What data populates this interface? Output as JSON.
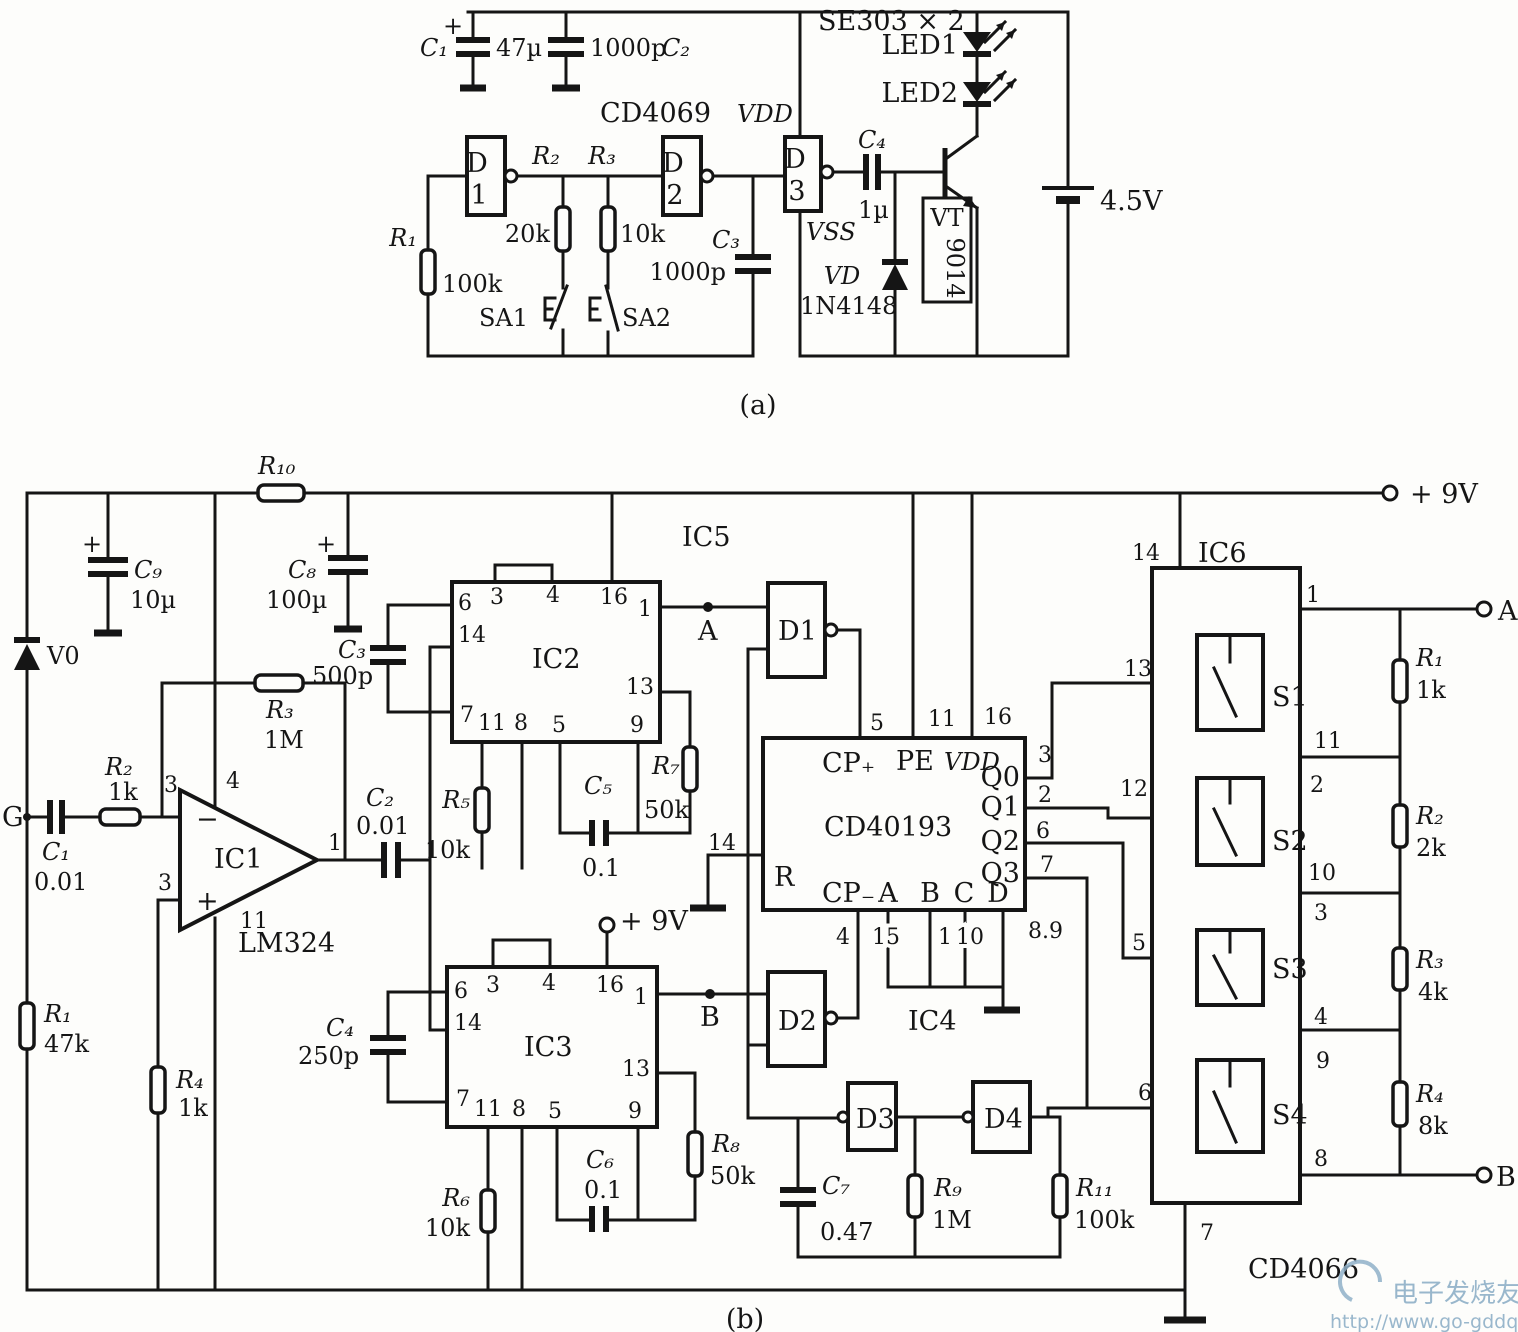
{
  "a": {
    "c1": "C₁",
    "plus": "+",
    "c1v": "47µ",
    "c2v": "1000p",
    "c2": "C₂",
    "ic": "CD4069",
    "vdd": "VDD",
    "vss": "VSS",
    "d": "D",
    "n1": "1",
    "n2": "2",
    "n3": "3",
    "r2": "R₂",
    "r2v": "20k",
    "r3": "R₃",
    "r3v": "10k",
    "r1": "R₁",
    "r1v": "100k",
    "sa1": "SA1",
    "sa2": "SA2",
    "c3": "C₃",
    "c3v": "1000p",
    "c4": "C₄",
    "c4v": "1µ",
    "vd": "VD",
    "vdv": "1N4148",
    "vt": "VT",
    "vtv": "9014",
    "se": "SE303 × 2",
    "led1": "LED1",
    "led2": "LED2",
    "bat": "4.5V",
    "cap": "(a)"
  },
  "b": {
    "pwr9": "+ 9V",
    "r10": "R₁₀",
    "c9": "C₉",
    "c9v": "10µ",
    "c8": "C₈",
    "c8v": "100µ",
    "c3": "C₃",
    "c3v": "500p",
    "v0": "V0",
    "r3": "R₃",
    "r3v": "1M",
    "r2": "R₂",
    "r2v": "1k",
    "c1": "C₁",
    "c1v": "0.01",
    "g": "G",
    "r1": "R₁",
    "r1v": "47k",
    "r4": "R₄",
    "r4v": "1k",
    "minus": "−",
    "plus": "+",
    "ic1": "IC1",
    "lm": "LM324",
    "icpins": [
      "6",
      "3",
      "4",
      "16",
      "1",
      "14",
      "13",
      "7",
      "11",
      "8",
      "5",
      "9"
    ],
    "c2": "C₂",
    "c2v": "0.01",
    "ic5": "IC5",
    "ic2": "IC2",
    "r5": "R₅",
    "r5v": "10k",
    "c5": "C₅",
    "c5v": "0.1",
    "r7": "R₇",
    "r7v": "50k",
    "a": "A",
    "d1": "D1",
    "d2": "D2",
    "d3": "D3",
    "d4": "D4",
    "c4": "C₄",
    "c4v": "250p",
    "ic3": "IC3",
    "r6": "R₆",
    "r6v": "10k",
    "c6": "C₆",
    "c6v": "0.1",
    "r8": "R₈",
    "r8v": "50k",
    "bnode": "B",
    "pwr9b": "+ 9V",
    "cd": "CD40193",
    "cpu": "CP₊",
    "pe": "PE",
    "vdd": "VDD",
    "r": "R",
    "cpd": "CP₋",
    "pa": "A",
    "pb": "B",
    "pc": "C",
    "pd": "D",
    "q0": "Q0",
    "q1": "Q1",
    "q2": "Q2",
    "q3": "Q3",
    "t5": "5",
    "t11": "11",
    "t16": "16",
    "t14": "14",
    "t4": "4",
    "t15": "15",
    "t1": "1",
    "t10": "10",
    "t89": "8.9",
    "ic4": "IC4",
    "q0p": "3",
    "q1p": "2",
    "q2p": "6",
    "q3p": "7",
    "s1c": "13",
    "s2c": "12",
    "s3c": "5",
    "s4c": "6",
    "c7": "C₇",
    "c7v": "0.47",
    "r9": "R₉",
    "r9v": "1M",
    "r11": "R₁₁",
    "r11v": "100k",
    "ic6": "IC6",
    "ic6p14": "14",
    "ic6p7": "7",
    "cd4066": "CD4066",
    "s1": "S1",
    "s2": "S2",
    "s3": "S3",
    "s4": "S4",
    "e1": "1",
    "e11": "11",
    "e2": "2",
    "e10": "10",
    "e3": "3",
    "e4": "4",
    "e9": "9",
    "e8": "8",
    "lr1": "R₁",
    "lr1v": "1k",
    "lr2": "R₂",
    "lr2v": "2k",
    "lr3": "R₃",
    "lr3v": "4k",
    "lr4": "R₄",
    "lr4v": "8k",
    "ta": "A",
    "tb": "B",
    "cap": "(b)"
  },
  "watermark": {
    "cn": "电子发烧友",
    "url": "http://www.go-gddq.com"
  }
}
